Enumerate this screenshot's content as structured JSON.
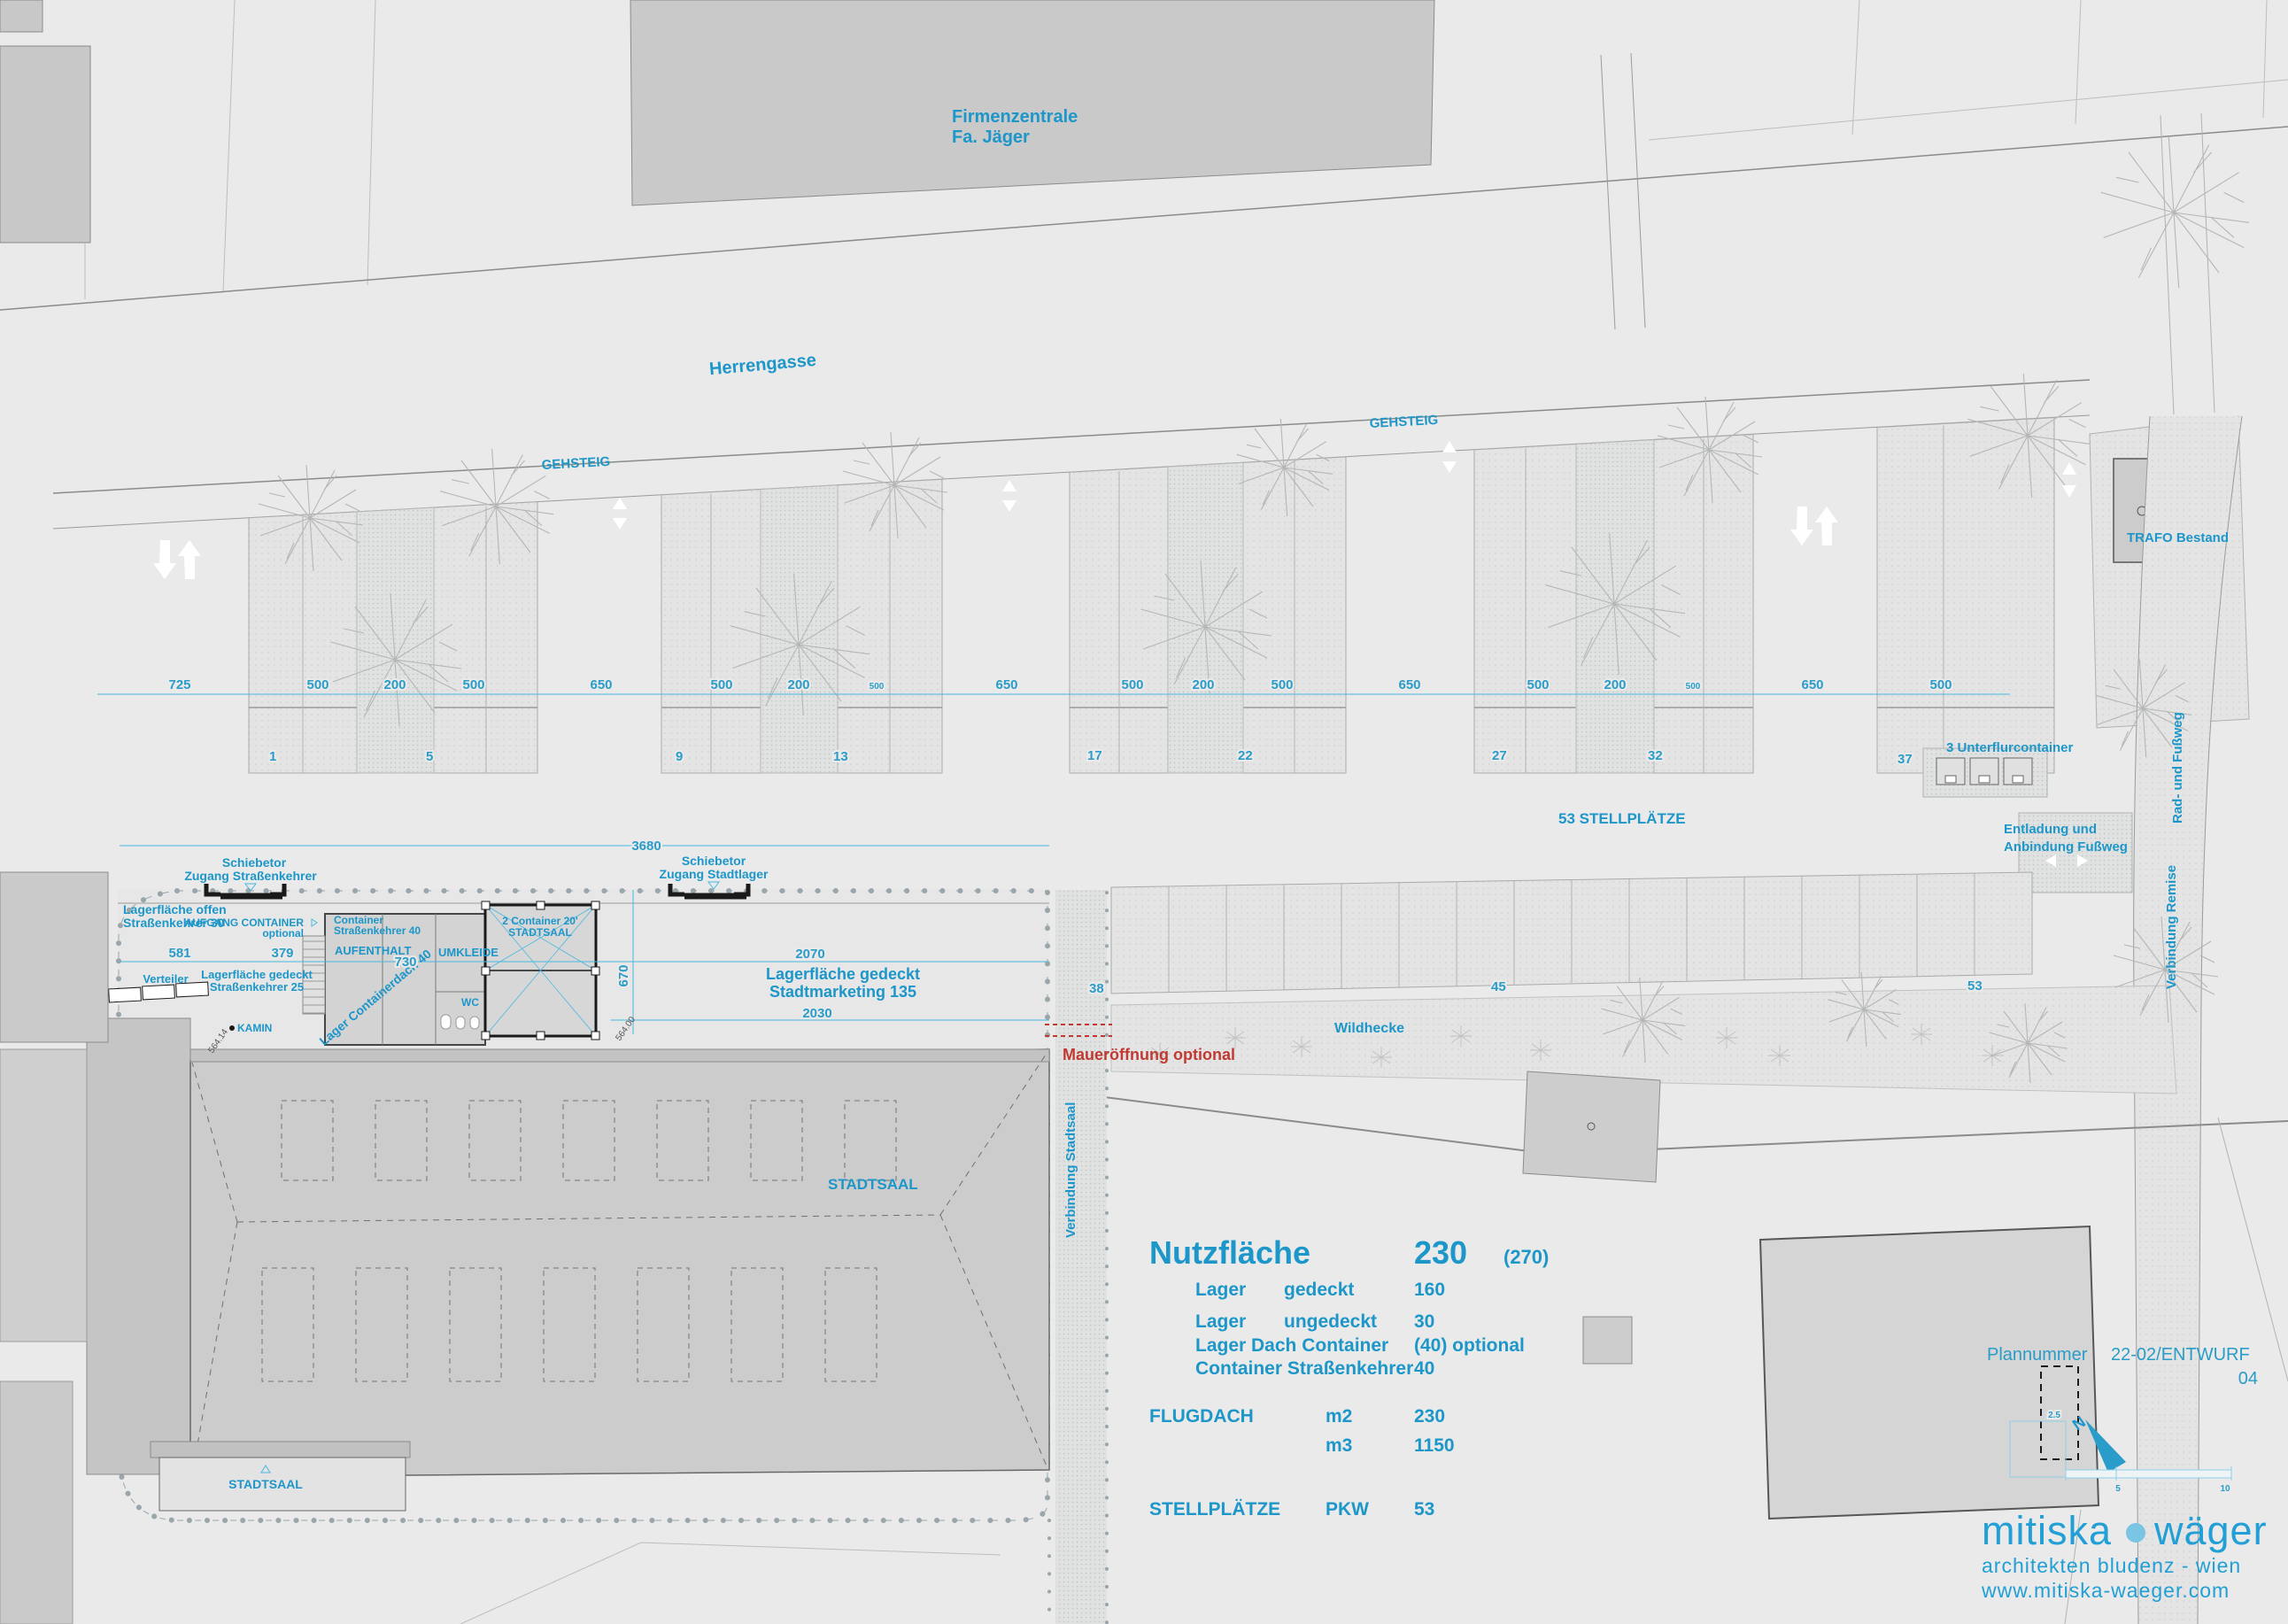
{
  "plan": {
    "street": "Herrengasse",
    "sidewalk_left": "GEHSTEIG",
    "sidewalk_right": "GEHSTEIG",
    "company_line1": "Firmenzentrale",
    "company_line2": "Fa. Jäger",
    "trafo": "TRAFO Bestand",
    "parking_total": "53 STELLPLÄTZE",
    "underfloor": "3 Unterflurcontainer",
    "unloading_line1": "Entladung und",
    "unloading_line2": "Anbindung Fußweg",
    "bike_path": "Rad- und Fußweg",
    "remise": "Verbindung Remise",
    "hedge": "Wildhecke",
    "hall": "STADTSAAL",
    "hall_entrance": "STADTSAAL",
    "wall_opening": "Maueröffnung optional",
    "hall_link": "Verbindung Stadtsaal",
    "gate1_line1": "Schiebetor",
    "gate1_line2": "Zugang  Straßenkehrer",
    "gate2_line1": "Schiebetor",
    "gate2_line2": "Zugang  Stadtlager",
    "open_storage_line1": "Lagerfläche offen",
    "open_storage_line2": "Straßenkehrer 30",
    "stair_line1": "AUFGANG CONTAINER",
    "stair_line2": "optional",
    "container_line1": "Container",
    "container_line2": "Straßenkehrer 40",
    "room_lounge": "AUFENTHALT",
    "room_changing": "UMKLEIDE",
    "room_wc": "WC",
    "container2_line1": "2 Container 20'",
    "container2_line2": "STADTSAAL",
    "roof_storage": "Lager Containerdach 40",
    "covered_storage1_line1": "Lagerfläche gedeckt",
    "covered_storage1_line2": "Straßenkehrer 25",
    "covered_storage2_line1": "Lagerfläche gedeckt",
    "covered_storage2_line2": "Stadtmarketing 135",
    "distributor": "Verteiler",
    "chimney": "KAMIN",
    "north": "N"
  },
  "dims": {
    "top": [
      "725",
      "500",
      "200",
      "500",
      "650",
      "500",
      "200",
      "500",
      "650",
      "500",
      "200",
      "500",
      "650",
      "500",
      "200",
      "500",
      "650",
      "500"
    ],
    "stall_numbers": [
      "1",
      "5",
      "9",
      "13",
      "17",
      "22",
      "27",
      "32",
      "37"
    ],
    "south_numbers": [
      "38",
      "45",
      "53"
    ],
    "d3680": "3680",
    "d581": "581",
    "d379": "379",
    "d730": "730",
    "d670": "670",
    "d2070": "2070",
    "d2030": "2030",
    "elev1": "564.14",
    "elev2": "564.00",
    "scale_grid": "2.5",
    "scale_mid": "5",
    "scale_end": "10"
  },
  "legend": {
    "title": "Nutzfläche",
    "title_value": "230",
    "title_paren": "(270)",
    "rows": [
      {
        "c1": "Lager",
        "c2": "gedeckt",
        "c3": "160"
      },
      {
        "c1": "Lager",
        "c2": "ungedeckt",
        "c3": "30"
      },
      {
        "c1": "Lager Dach Container",
        "c2": "",
        "c3": "(40) optional"
      },
      {
        "c1": "Container Straßenkehrer",
        "c2": "",
        "c3": "40"
      }
    ],
    "flugdach_label": "FLUGDACH",
    "flugdach_rows": [
      {
        "unit": "m2",
        "value": "230"
      },
      {
        "unit": "m3",
        "value": "1150"
      }
    ],
    "stellplaetze_label": "STELLPLÄTZE",
    "stellplaetze_unit": "PKW",
    "stellplaetze_value": "53"
  },
  "titleblock": {
    "plan_label": "Plannummer",
    "plan_number": "22-02/ENTWURF",
    "revision": "04"
  },
  "logo": {
    "word1": "mitiska",
    "word2": "wäger",
    "tagline": "architekten  bludenz - wien",
    "url": "www.mitiska-waeger.com"
  },
  "colors": {
    "accent": "#1d96c9",
    "logo_blue": "#219fd6",
    "dim_line": "#49b8e0",
    "red": "#c03a32",
    "background": "#e9eae9"
  }
}
